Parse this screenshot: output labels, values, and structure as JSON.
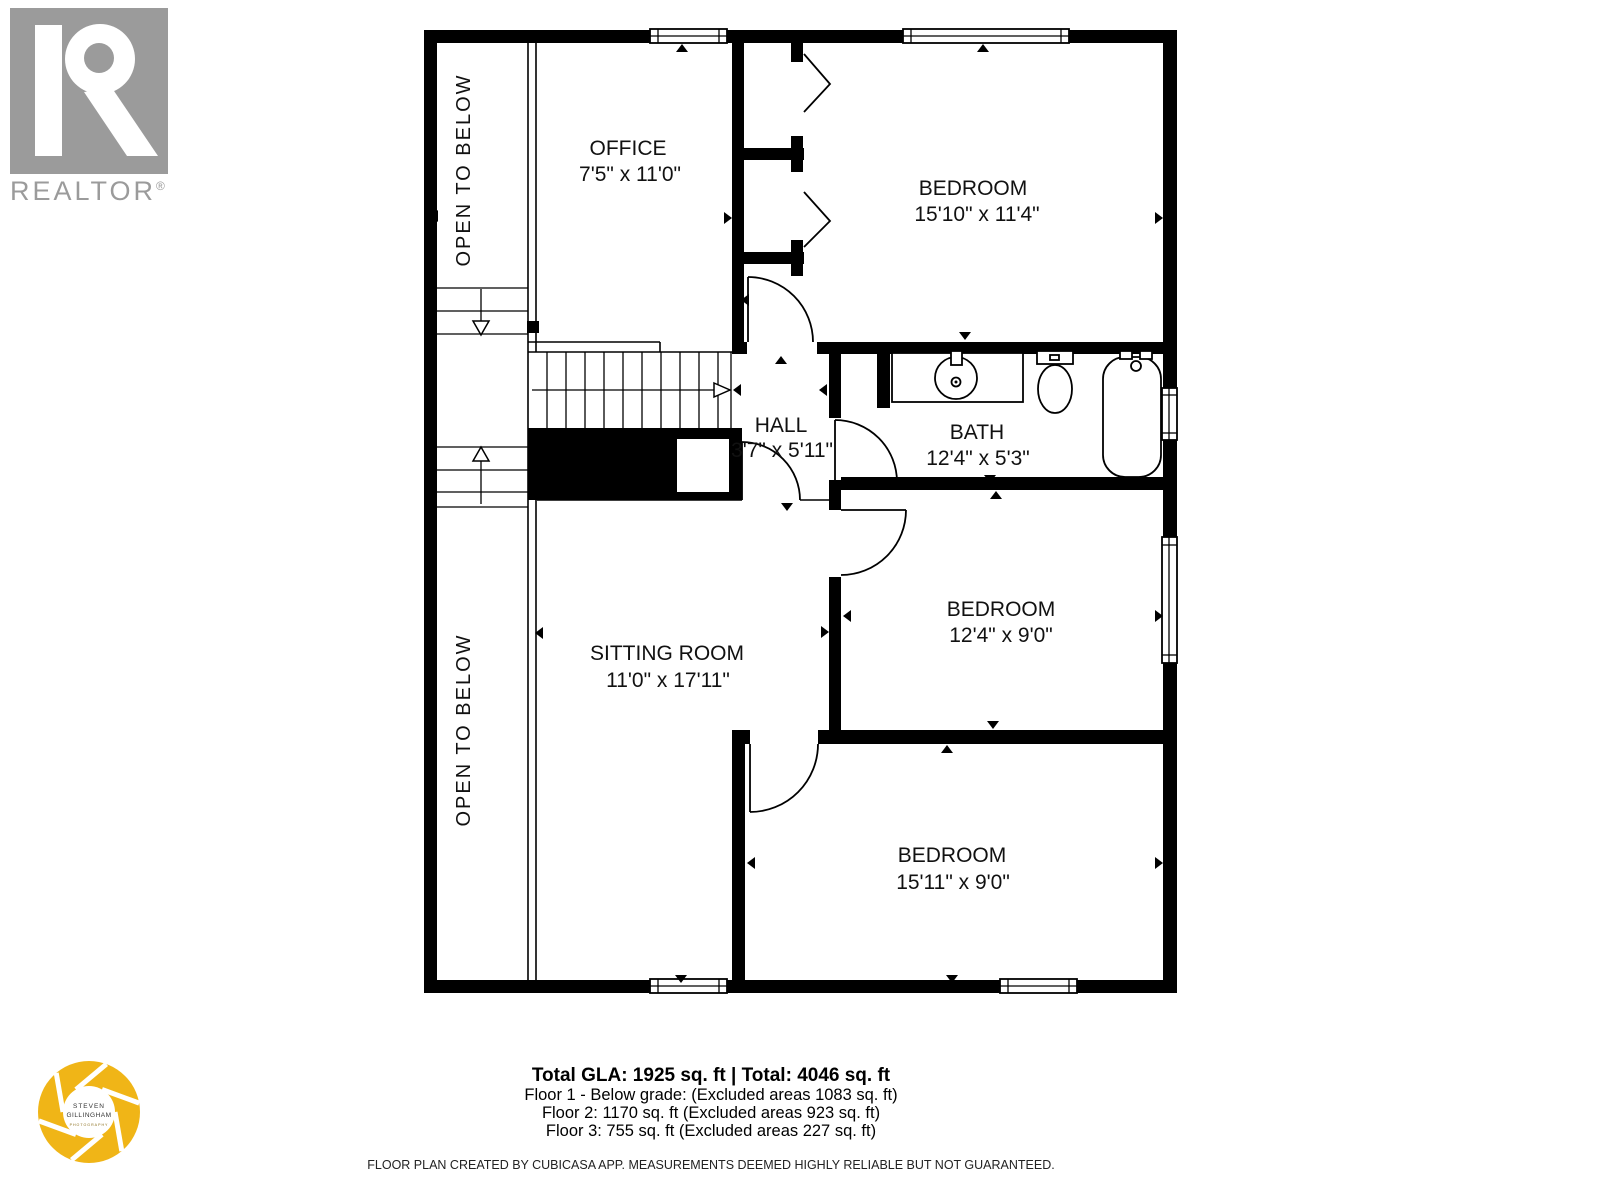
{
  "realtor_logo": {
    "wordmark": "REALTOR",
    "registered": "®"
  },
  "photographer_logo": {
    "name_line1": "STEVEN",
    "name_line2": "GILLINGHAM",
    "subtitle": "PHOTOGRAPHY"
  },
  "plan": {
    "rooms": [
      {
        "name": "OFFICE",
        "dims": "7'5\" x 11'0\""
      },
      {
        "name": "BEDROOM",
        "dims": "15'10\" x 11'4\""
      },
      {
        "name": "HALL",
        "dims": "3'7\" x 5'11\""
      },
      {
        "name": "BATH",
        "dims": "12'4\" x 5'3\""
      },
      {
        "name": "SITTING ROOM",
        "dims": "11'0\" x 17'11\""
      },
      {
        "name": "BEDROOM",
        "dims": "12'4\" x 9'0\""
      },
      {
        "name": "BEDROOM",
        "dims": "15'11\" x 9'0\""
      }
    ],
    "open_to_below_upper": "OPEN TO BELOW",
    "open_to_below_lower": "OPEN TO BELOW"
  },
  "summary": {
    "title": "Total GLA: 1925 sq. ft | Total: 4046 sq. ft",
    "lines": [
      "Floor 1 - Below grade: (Excluded areas 1083 sq. ft)",
      "Floor 2: 1170 sq. ft (Excluded areas 923 sq. ft)",
      "Floor 3: 755 sq. ft (Excluded areas 227 sq. ft)"
    ],
    "disclaimer": "FLOOR PLAN CREATED BY CUBICASA APP. MEASUREMENTS DEEMED HIGHLY RELIABLE BUT NOT GUARANTEED."
  },
  "colors": {
    "wall": "#000000",
    "realtor_gray": "#9b9b9b",
    "aperture_yellow": "#F0B517"
  }
}
